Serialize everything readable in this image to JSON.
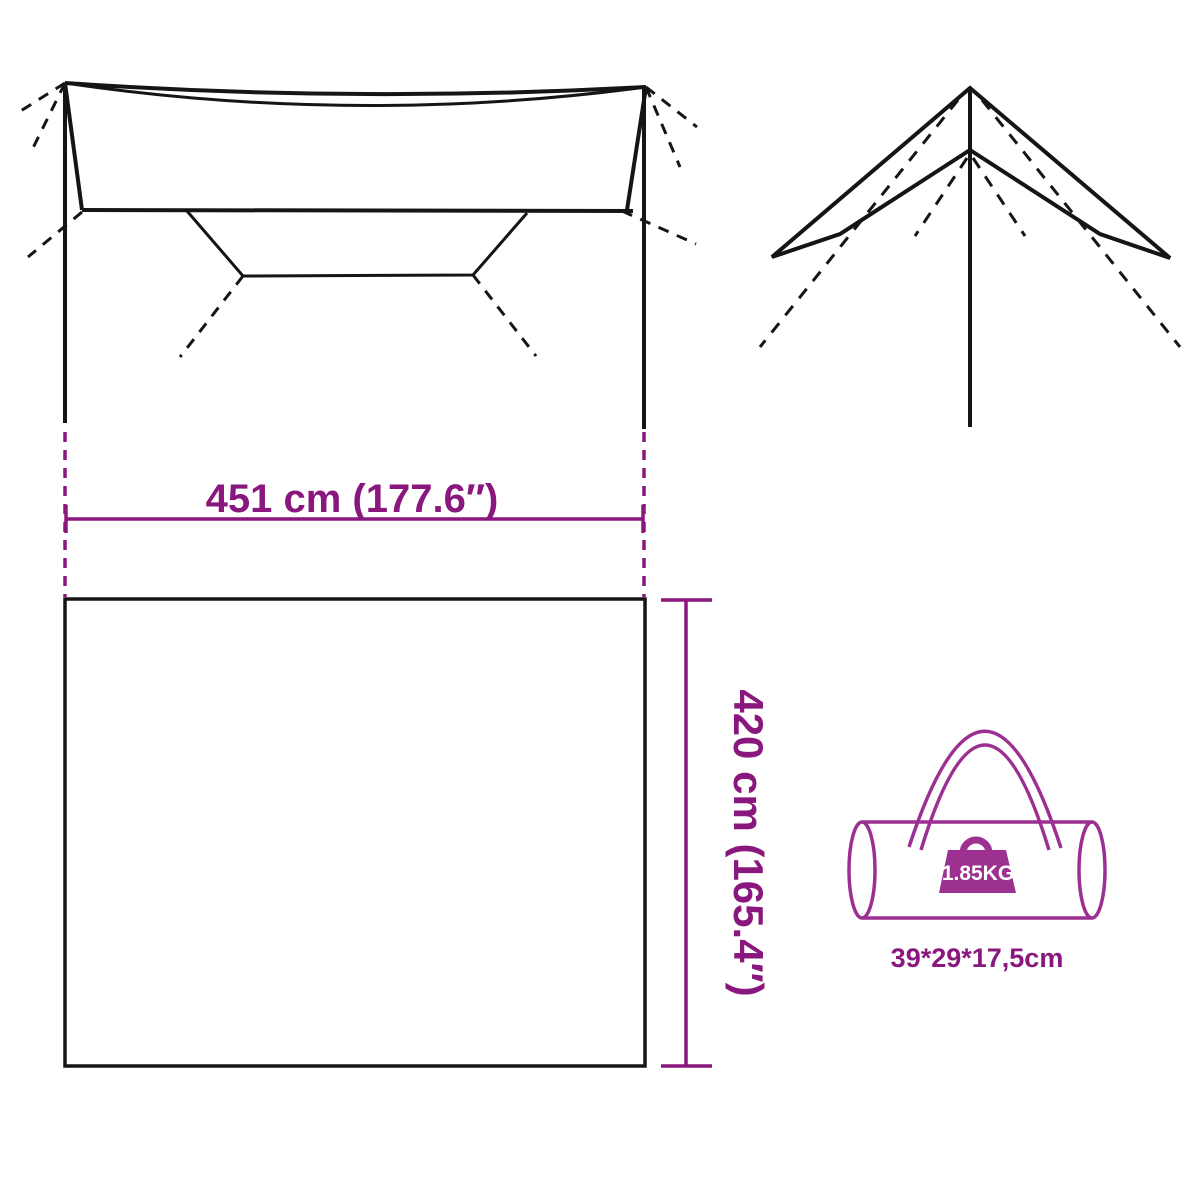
{
  "diagram": {
    "width_dimension": {
      "label": "451 cm (177.6″)"
    },
    "height_dimension": {
      "label": "420 cm (165.4″)"
    },
    "bag": {
      "weight_label": "1.85KG",
      "size_label": "39*29*17,5cm"
    }
  },
  "icons": {
    "tarp_top_view": "tarp-top-view-diagram",
    "tarp_pitched_view": "tarp-pitched-view-diagram",
    "carry_bag": "carry-bag-icon",
    "weight": "weight-icon"
  },
  "colors": {
    "accent_purple": "#8a177d",
    "bag_outline_purple": "#9b2f92",
    "weight_fill_purple": "#9c3192",
    "weight_text": "#ffffff",
    "line_black": "#151515",
    "background": "#ffffff"
  }
}
